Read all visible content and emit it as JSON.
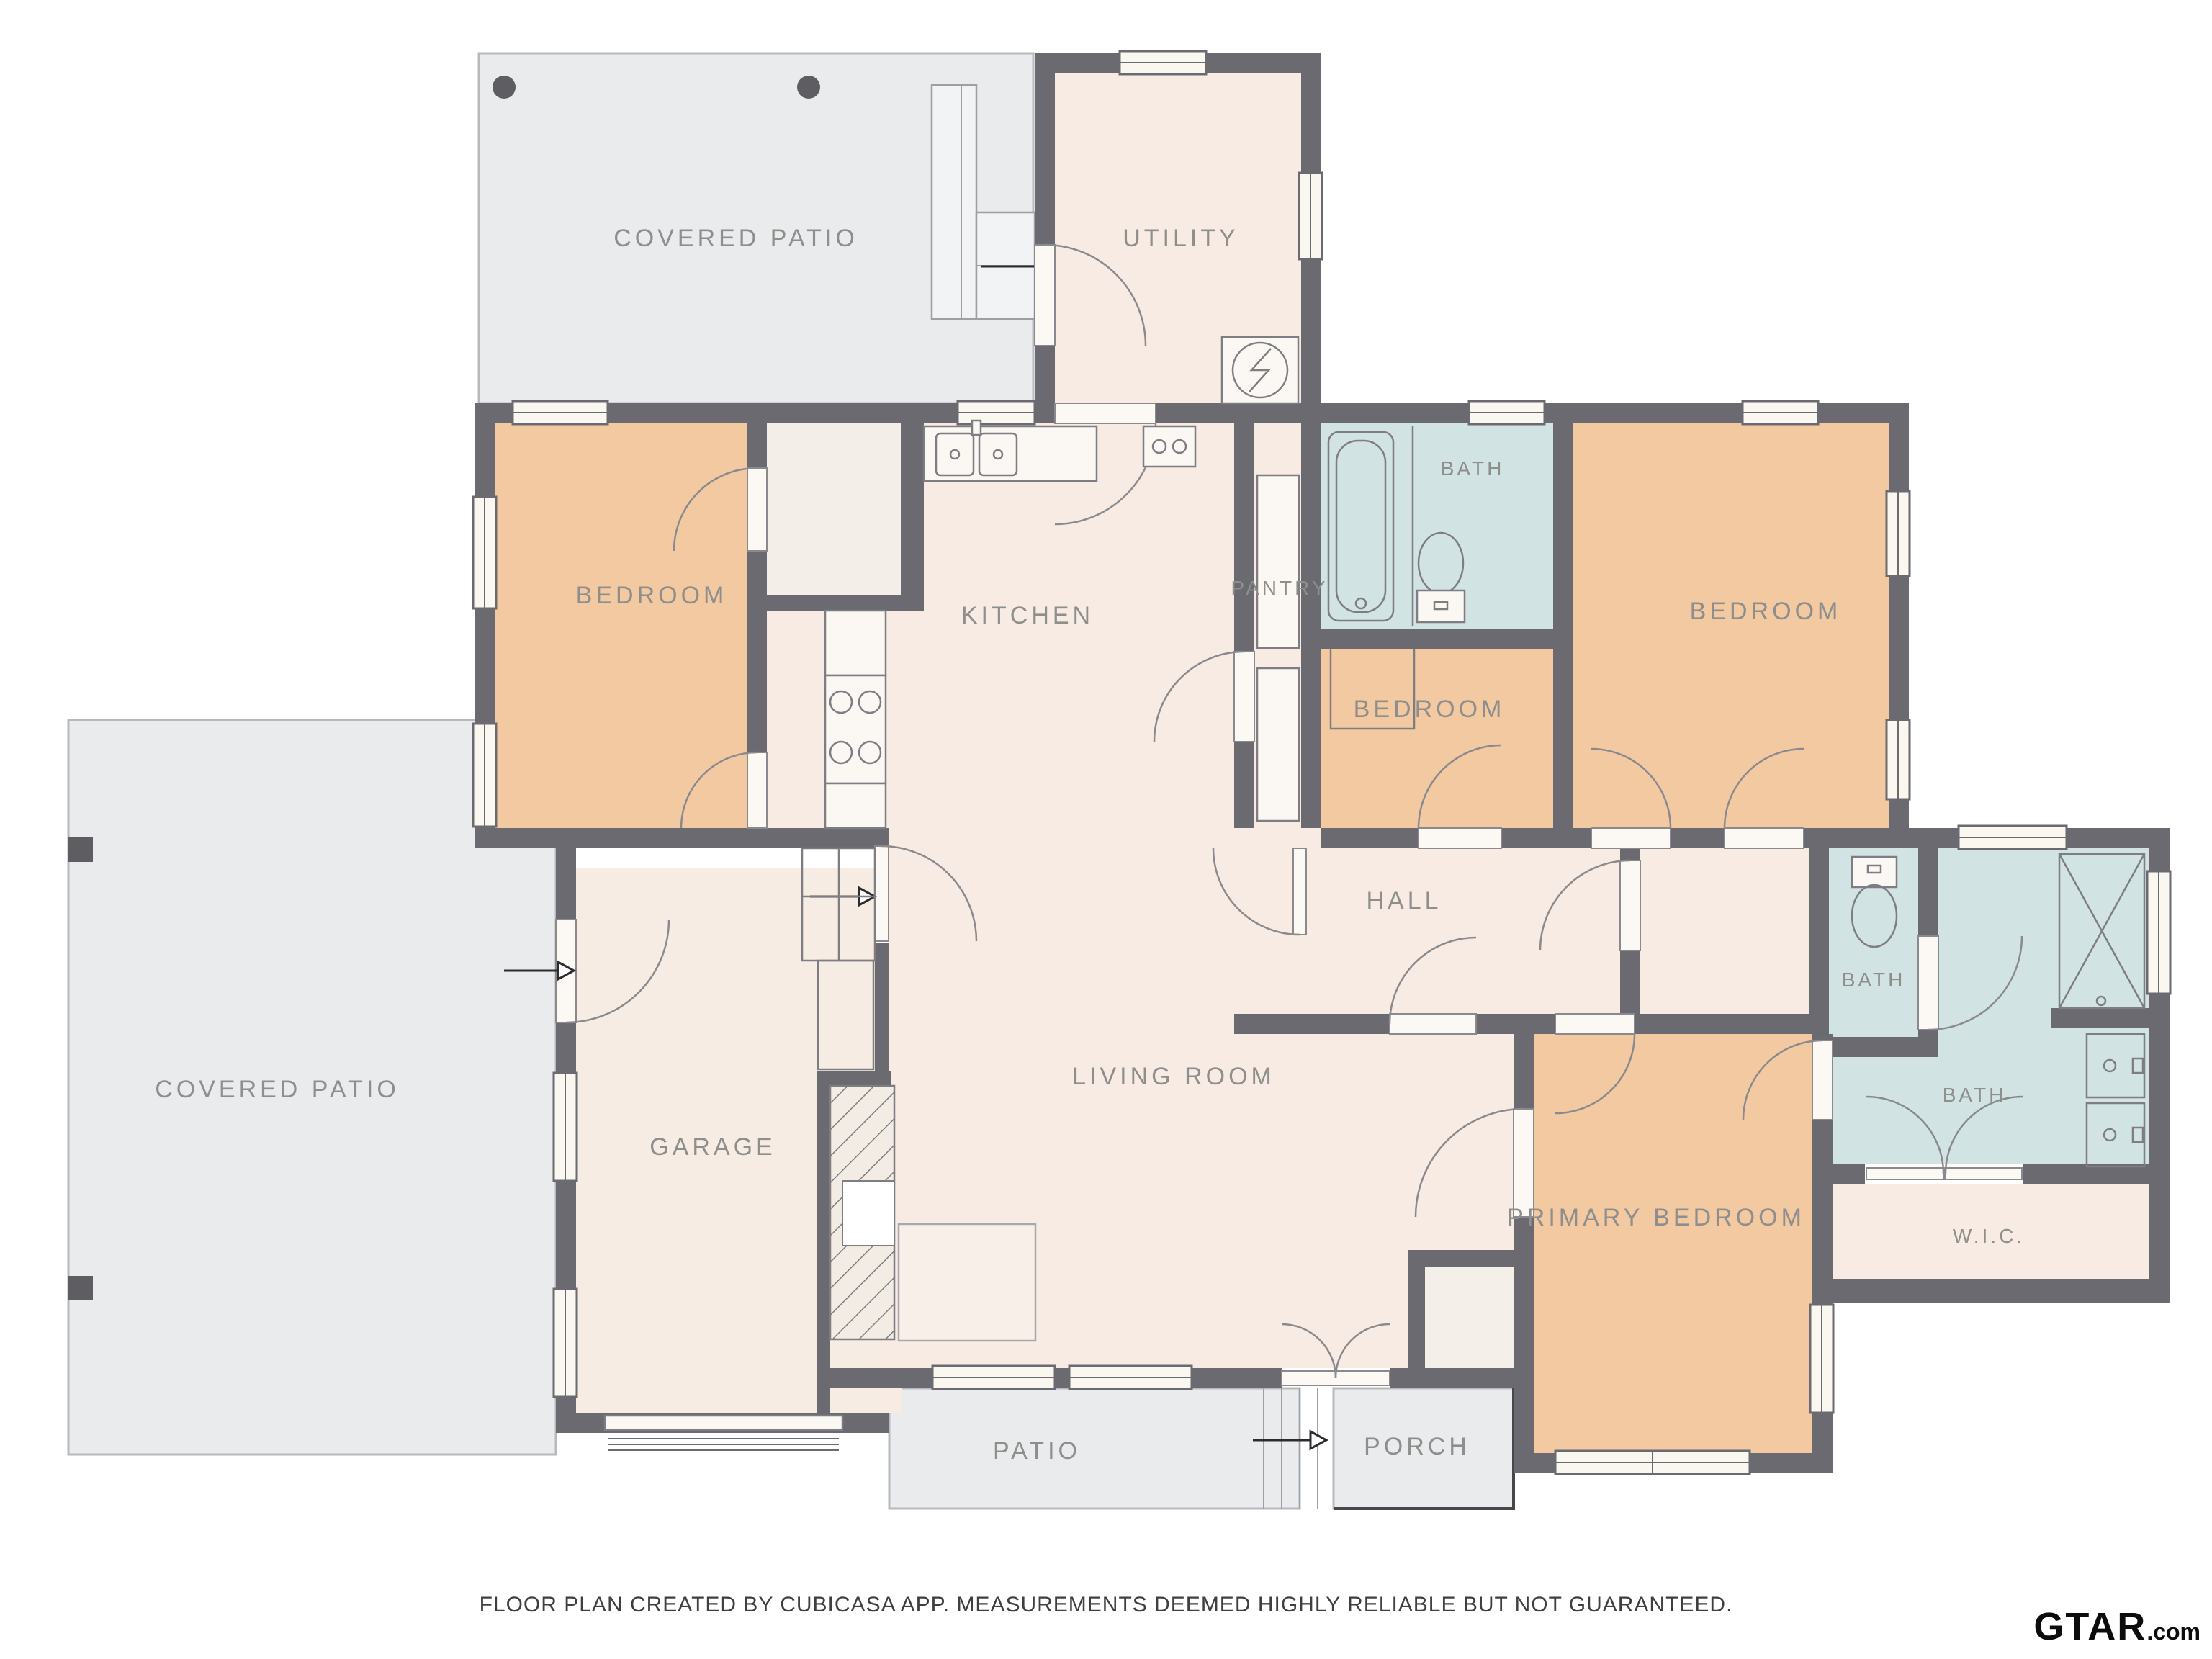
{
  "rooms": [
    {
      "name": "covered-patio-top",
      "label": "COVERED PATIO"
    },
    {
      "name": "utility",
      "label": "UTILITY"
    },
    {
      "name": "bedroom-top-left",
      "label": "BEDROOM"
    },
    {
      "name": "kitchen",
      "label": "KITCHEN"
    },
    {
      "name": "pantry",
      "label": "PANTRY"
    },
    {
      "name": "bath-hall",
      "label": "BATH"
    },
    {
      "name": "bedroom-middle",
      "label": "BEDROOM"
    },
    {
      "name": "bedroom-top-right",
      "label": "BEDROOM"
    },
    {
      "name": "hall",
      "label": "HALL"
    },
    {
      "name": "covered-patio-left",
      "label": "COVERED PATIO"
    },
    {
      "name": "garage",
      "label": "GARAGE"
    },
    {
      "name": "living-room",
      "label": "LIVING ROOM"
    },
    {
      "name": "primary-bedroom",
      "label": "PRIMARY BEDROOM"
    },
    {
      "name": "bath-toilet",
      "label": "BATH"
    },
    {
      "name": "bath-primary",
      "label": "BATH"
    },
    {
      "name": "walk-in-closet",
      "label": "W.I.C."
    },
    {
      "name": "patio",
      "label": "PATIO"
    },
    {
      "name": "porch",
      "label": "PORCH"
    }
  ],
  "footer": {
    "disclaimer": "FLOOR PLAN CREATED BY CUBICASA APP. MEASUREMENTS DEEMED HIGHLY RELIABLE BUT NOT GUARANTEED."
  },
  "logo": {
    "brand": "GTAR",
    "suffix": ".com"
  },
  "colors": {
    "wall": "#6a6a70",
    "room_cream": "#f7ebe3",
    "bedroom_orange": "#f3c9a2",
    "bath_blue": "#d2e3e4",
    "patio_gray": "#e9ebed",
    "label_gray": "#8e8e8c",
    "footer_text": "#3f3f3f",
    "logo_black": "#0c0c0c"
  }
}
